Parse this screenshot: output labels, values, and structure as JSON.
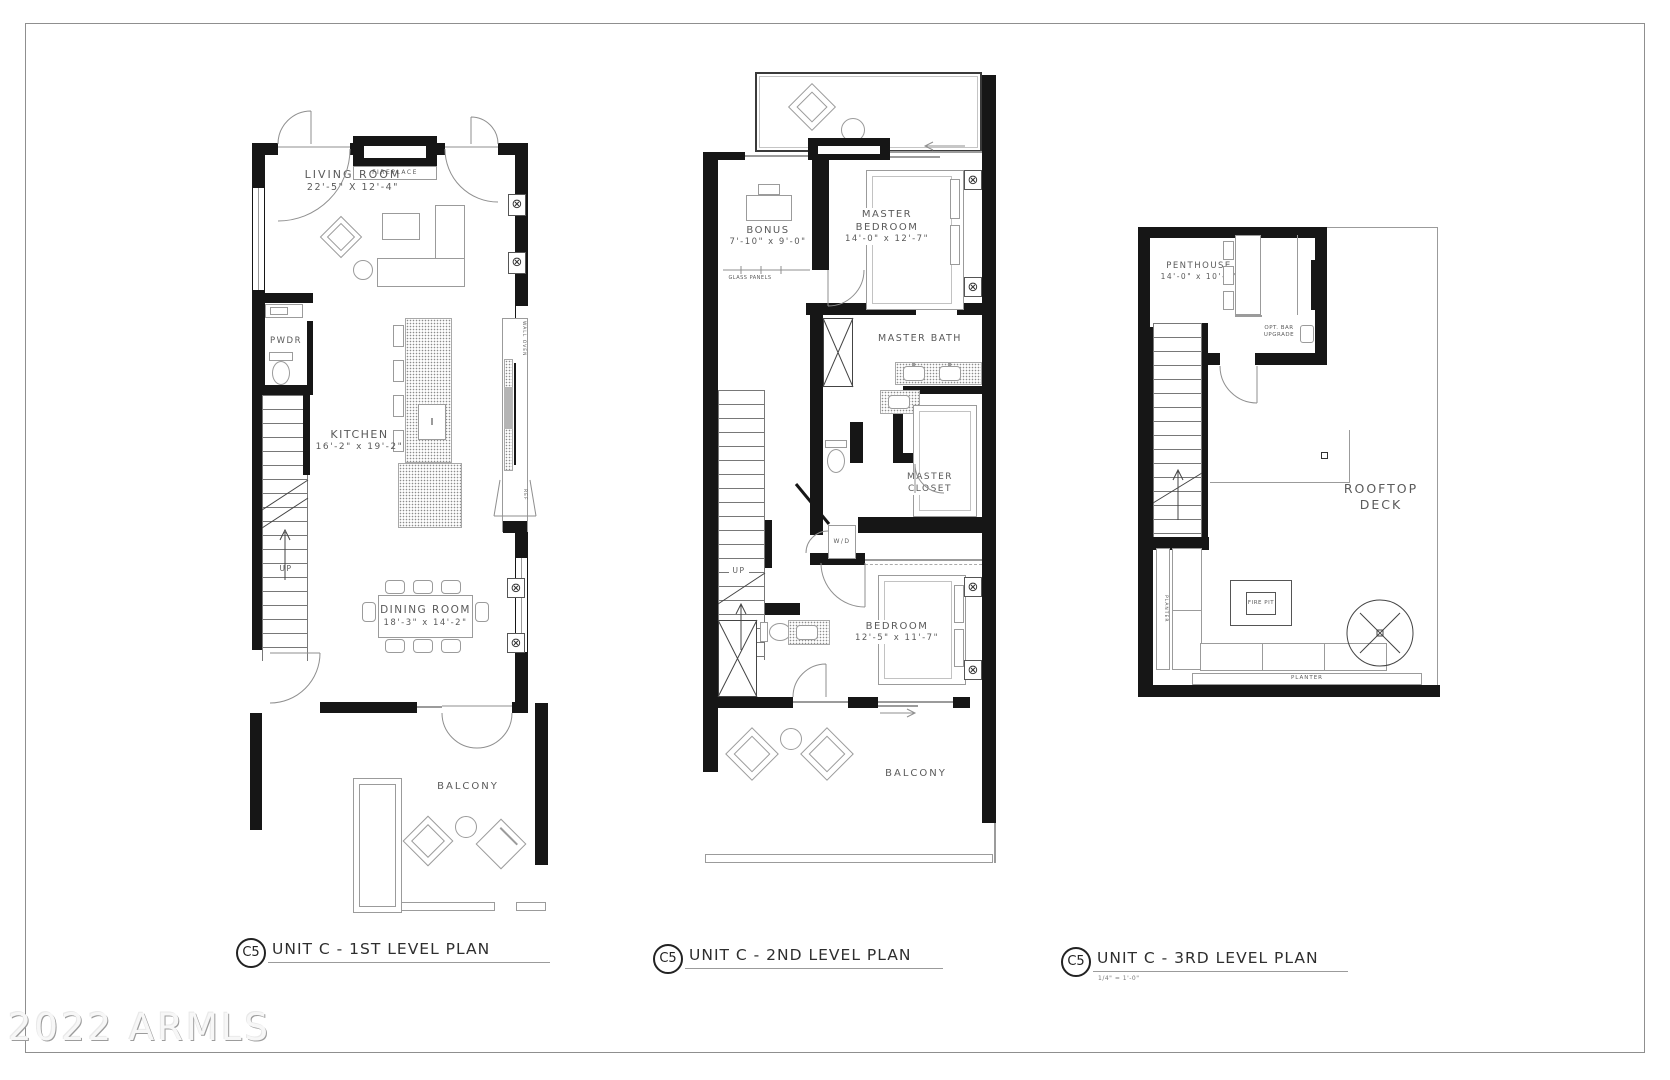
{
  "watermark": "2022 ARMLS",
  "symbols": {
    "fixture": "⊗"
  },
  "plans": [
    {
      "marker": "C5",
      "title": "UNIT C - 1ST LEVEL PLAN",
      "labels": {
        "fireplace": "FIREPLACE",
        "living_name": "LIVING ROOM",
        "living_dims": "22'-5\" X 12'-4\"",
        "pwdr": "PWDR",
        "kitchen_name": "KITCHEN",
        "kitchen_dims": "16'-2\" x 19'-2\"",
        "dining_name": "DINING ROOM",
        "dining_dims": "18'-3\" x 14'-2\"",
        "balcony": "BALCONY",
        "up": "UP",
        "wall_oven": "WALL OVEN",
        "ref": "REF"
      }
    },
    {
      "marker": "C5",
      "title": "UNIT C - 2ND LEVEL PLAN",
      "labels": {
        "bonus_name": "BONUS",
        "bonus_dims": "7'-10\" x 9'-0\"",
        "glass_panels": "GLASS PANELS",
        "master_bedroom_name": "MASTER BEDROOM",
        "master_bedroom_dims": "14'-0\" x 12'-7\"",
        "master_bath": "MASTER BATH",
        "master_closet": "MASTER CLOSET",
        "bedroom_name": "BEDROOM",
        "bedroom_dims": "12'-5\" x 11'-7\"",
        "balcony": "BALCONY",
        "up": "UP",
        "wd": "W/D"
      }
    },
    {
      "marker": "C5",
      "title": "UNIT C - 3RD LEVEL PLAN",
      "scale_note": "1/4\" = 1'-0\"",
      "labels": {
        "penthouse_name": "PENTHOUSE",
        "penthouse_dims": "14'-0\" x 10'-2\"",
        "opt_bar": "OPT. BAR UPGRADE",
        "rooftop_deck": "ROOFTOP DECK",
        "fire_pit": "FIRE PIT",
        "planter_left": "PLANTER",
        "planter_bottom": "PLANTER"
      }
    }
  ]
}
